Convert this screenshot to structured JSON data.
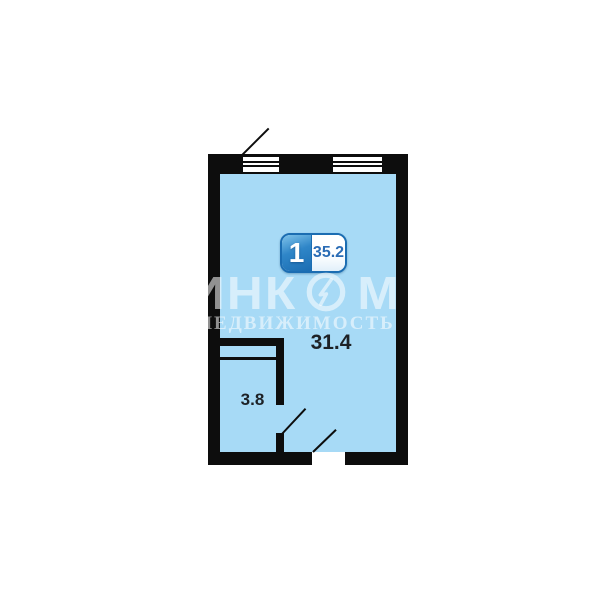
{
  "floorplan": {
    "unit_badge": {
      "rooms": "1",
      "total_area": "35.2"
    },
    "rooms": [
      {
        "name": "main-room",
        "area_label": "31.4"
      },
      {
        "name": "bathroom",
        "area_label": "3.8"
      }
    ],
    "colors": {
      "wall": "#0d0d0d",
      "room_fill": "#a7daf6",
      "badge_blue_dark": "#1b6db2",
      "badge_blue_light": "#7fc3ea",
      "badge_value_text": "#2a6cb5",
      "area_label_text": "#1d2126"
    }
  },
  "watermark": {
    "brand_left": "ИНК",
    "brand_right": "М",
    "subtitle": "НЕДВИЖИМОСТЬ",
    "color": "rgba(255,255,255,0.55)"
  }
}
